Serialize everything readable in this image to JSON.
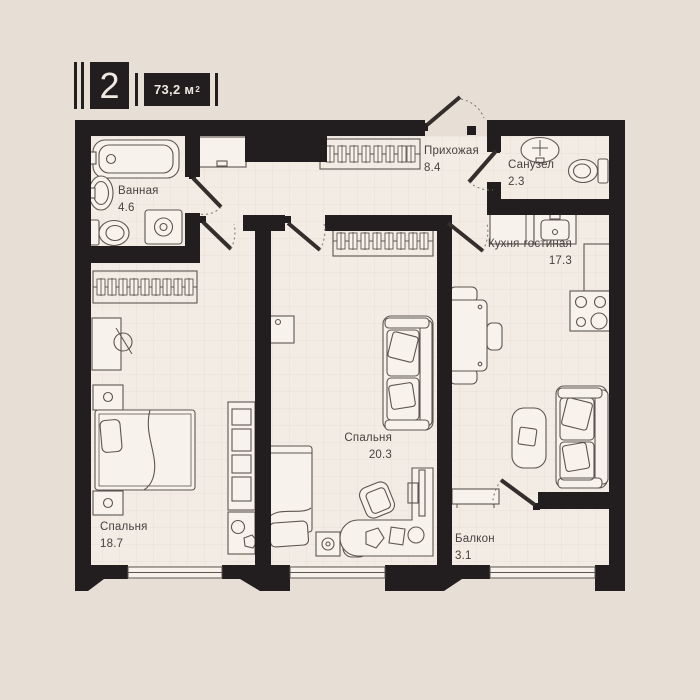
{
  "header": {
    "number": "2",
    "area_value": "73,2 м",
    "area_sup": "2"
  },
  "rooms": [
    {
      "id": "bathroom",
      "name": "Ванная",
      "area": "4.6"
    },
    {
      "id": "hallway",
      "name": "Прихожая",
      "area": "8.4"
    },
    {
      "id": "wc",
      "name": "Санузел",
      "area": "2.3"
    },
    {
      "id": "kitchen-living",
      "name": "Кухня-гостиная",
      "area": "17.3"
    },
    {
      "id": "bedroom-2",
      "name": "Спальня",
      "area": "20.3"
    },
    {
      "id": "bedroom-1",
      "name": "Спальня",
      "area": "18.7"
    },
    {
      "id": "balcony",
      "name": "Балкон",
      "area": "3.1"
    }
  ],
  "colors": {
    "background": "#e7ded6",
    "floor": "#f3ece4",
    "walls": "#221e1f",
    "furniture_stroke": "#5c5550",
    "label_text": "#474140"
  }
}
